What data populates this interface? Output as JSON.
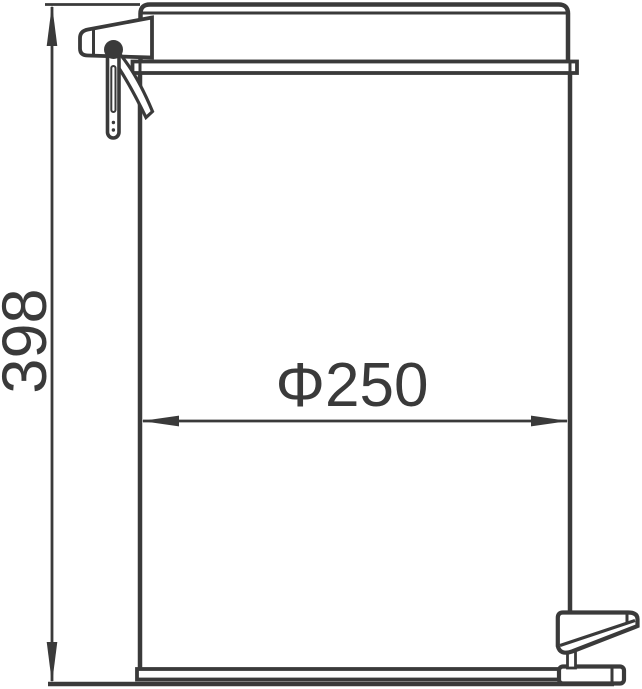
{
  "diagram": {
    "type": "technical-line-drawing",
    "subject": "pedal waste bin side elevation with dimensions",
    "labels": {
      "height_mm": "398",
      "diameter_mm": "Φ250"
    },
    "colors": {
      "line": "#3a3a3a",
      "background": "#ffffff"
    }
  }
}
